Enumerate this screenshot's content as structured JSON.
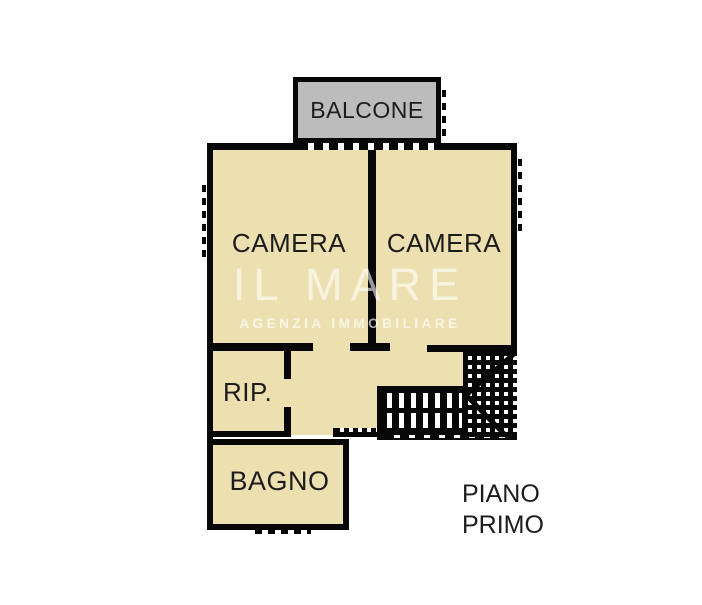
{
  "plan": {
    "rooms": [
      {
        "name": "balcone",
        "label": "BALCONE"
      },
      {
        "name": "camera-left",
        "label": "CAMERA"
      },
      {
        "name": "camera-right",
        "label": "CAMERA"
      },
      {
        "name": "ripostiglio",
        "label": "RIP."
      },
      {
        "name": "bagno",
        "label": "BAGNO"
      }
    ],
    "floor_label": {
      "line1": "PIANO",
      "line2": "PRIMO"
    },
    "watermark": {
      "name": "IL MARE",
      "tagline": "AGENZIA IMMOBILIARE"
    },
    "colors": {
      "background": "#ffffff",
      "room_fill": "#ede0b0",
      "balcony_fill": "#bcbcbc",
      "wall": "#070707",
      "label_text": "#1c1c1c"
    }
  }
}
